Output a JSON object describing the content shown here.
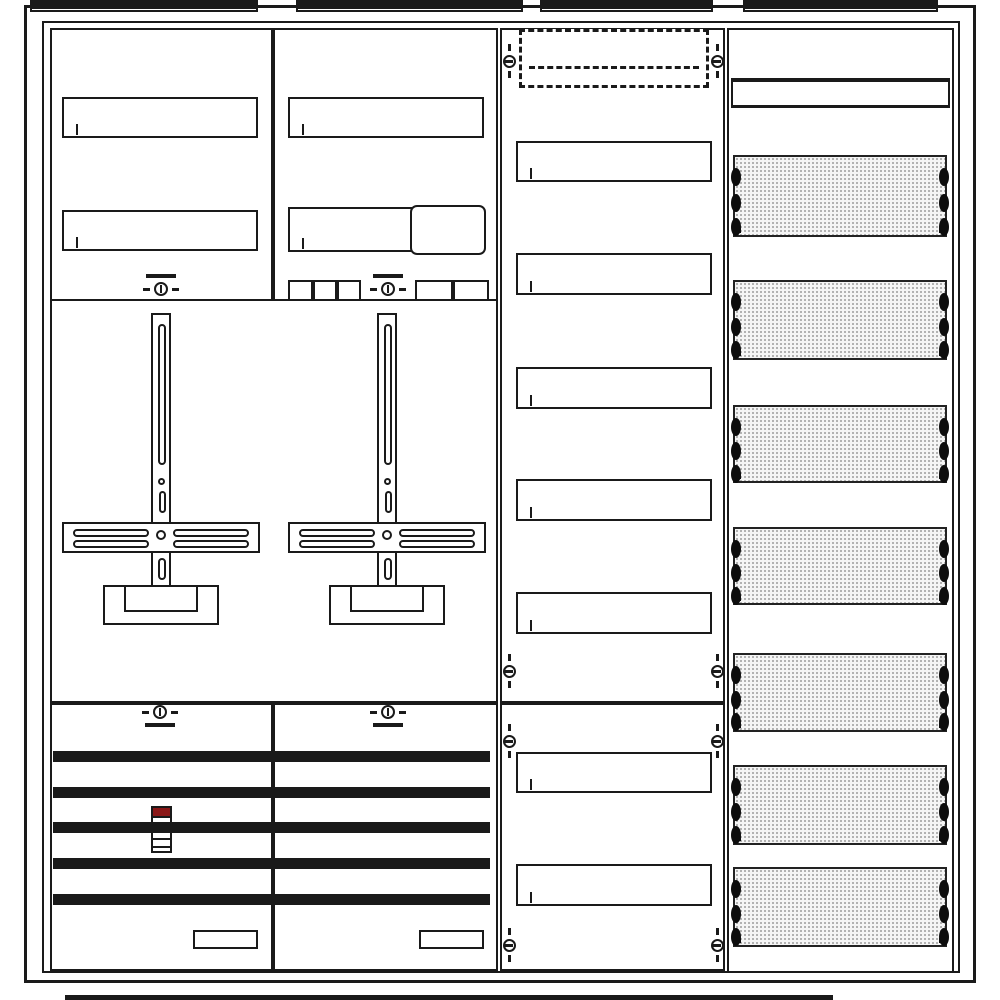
{
  "diagram": {
    "description": "Electrical meter cabinet internal layout line diagram, 4 columns",
    "colors": {
      "line": "#1a1a1a",
      "red_accent": "#8a1717",
      "plate_fill": "#f5f5f5",
      "plate_dot": "#9c9c9c",
      "background": "#ffffff"
    },
    "frame": {
      "outer": [
        24,
        5,
        952,
        978
      ],
      "inner": [
        42,
        21,
        918,
        952
      ]
    },
    "top_brackets": [
      [
        30,
        0,
        228,
        7
      ],
      [
        296,
        0,
        227,
        7
      ],
      [
        540,
        0,
        173,
        7
      ],
      [
        743,
        0,
        195,
        7
      ]
    ],
    "bottom_bracket": [
      65,
      995,
      768,
      5
    ],
    "panels": [
      {
        "name": "panel-top-left",
        "r": [
          50,
          28,
          223,
          273
        ]
      },
      {
        "name": "panel-top-right",
        "r": [
          273,
          28,
          225,
          273
        ]
      },
      {
        "name": "panel-middle-meter-field",
        "r": [
          50,
          299,
          448,
          404
        ]
      },
      {
        "name": "panel-bottom-left",
        "r": [
          50,
          703,
          223,
          268
        ]
      },
      {
        "name": "panel-bottom-right",
        "r": [
          273,
          703,
          225,
          268
        ]
      },
      {
        "name": "column3-upper-panel",
        "r": [
          500,
          28,
          225,
          675
        ]
      },
      {
        "name": "column3-lower-panel",
        "r": [
          500,
          703,
          225,
          268
        ]
      },
      {
        "name": "column4-din-column",
        "r": [
          727,
          28,
          227,
          945
        ]
      }
    ],
    "din_rails": [
      {
        "r": [
          62,
          97,
          196,
          41
        ],
        "ticks": 11
      },
      {
        "r": [
          288,
          97,
          196,
          41
        ],
        "ticks": 11
      },
      {
        "r": [
          62,
          210,
          196,
          41
        ],
        "ticks": 11
      },
      {
        "r": [
          288,
          207,
          140,
          45
        ],
        "ticks": 7
      },
      {
        "r": [
          516,
          141,
          196,
          41
        ],
        "ticks": 11
      },
      {
        "r": [
          516,
          253,
          196,
          42
        ],
        "ticks": 11
      },
      {
        "r": [
          516,
          367,
          196,
          42
        ],
        "ticks": 11
      },
      {
        "r": [
          516,
          479,
          196,
          42
        ],
        "ticks": 11
      },
      {
        "r": [
          516,
          592,
          196,
          42
        ],
        "ticks": 11
      },
      {
        "r": [
          516,
          752,
          196,
          41
        ],
        "ticks": 11
      },
      {
        "r": [
          516,
          864,
          196,
          42
        ],
        "ticks": 11
      }
    ],
    "striped_devices": [
      {
        "name": "sls-switch-block",
        "r": [
          410,
          205,
          76,
          50
        ],
        "cells": 7,
        "rounded": true
      },
      {
        "name": "terminal-strip",
        "r": [
          193,
          930,
          65,
          19
        ],
        "cells": 7,
        "rounded": false
      },
      {
        "name": "terminal-strip",
        "r": [
          419,
          930,
          65,
          19
        ],
        "cells": 7,
        "rounded": false
      }
    ],
    "small_boxes": [
      [
        288,
        280,
        25,
        21
      ],
      [
        313,
        280,
        24,
        21
      ],
      [
        337,
        280,
        24,
        21
      ],
      [
        415,
        280,
        38,
        21
      ],
      [
        453,
        280,
        36,
        21
      ]
    ],
    "meter_crosses": [
      {
        "cx": 161,
        "top": 313
      },
      {
        "cx": 387,
        "top": 313
      }
    ],
    "seal_screws": [
      {
        "cx": 161,
        "cy": 289,
        "bar": "above"
      },
      {
        "cx": 388,
        "cy": 289,
        "bar": "above"
      },
      {
        "cx": 160,
        "cy": 712,
        "bar": "below"
      },
      {
        "cx": 388,
        "cy": 712,
        "bar": "below"
      }
    ],
    "fixing_screws": [
      {
        "cx": 509,
        "cy": 61
      },
      {
        "cx": 717,
        "cy": 61
      },
      {
        "cx": 509,
        "cy": 671
      },
      {
        "cx": 717,
        "cy": 671
      },
      {
        "cx": 509,
        "cy": 741
      },
      {
        "cx": 717,
        "cy": 741
      },
      {
        "cx": 509,
        "cy": 945
      },
      {
        "cx": 717,
        "cy": 945
      }
    ],
    "dashed_reserve": {
      "r": [
        519,
        29,
        190,
        59
      ],
      "mid_line_at": 34
    },
    "busbars": {
      "x": 53,
      "w": 437,
      "h": 11,
      "ys": [
        751,
        787,
        822,
        858,
        894
      ]
    },
    "sls_device": {
      "r": [
        151,
        806,
        21,
        47
      ],
      "cap_h": 10,
      "lines_at": [
        30,
        38
      ]
    },
    "cover_strip": [
      731,
      78,
      219,
      30
    ],
    "perforated_plates": [
      [
        733,
        155,
        214,
        82
      ],
      [
        733,
        280,
        214,
        80
      ],
      [
        733,
        405,
        214,
        78
      ],
      [
        733,
        527,
        214,
        78
      ],
      [
        733,
        653,
        214,
        79
      ],
      [
        733,
        765,
        214,
        80
      ],
      [
        733,
        867,
        214,
        80
      ]
    ],
    "plate_screw_fractions": [
      0.14,
      0.45,
      0.74
    ]
  }
}
